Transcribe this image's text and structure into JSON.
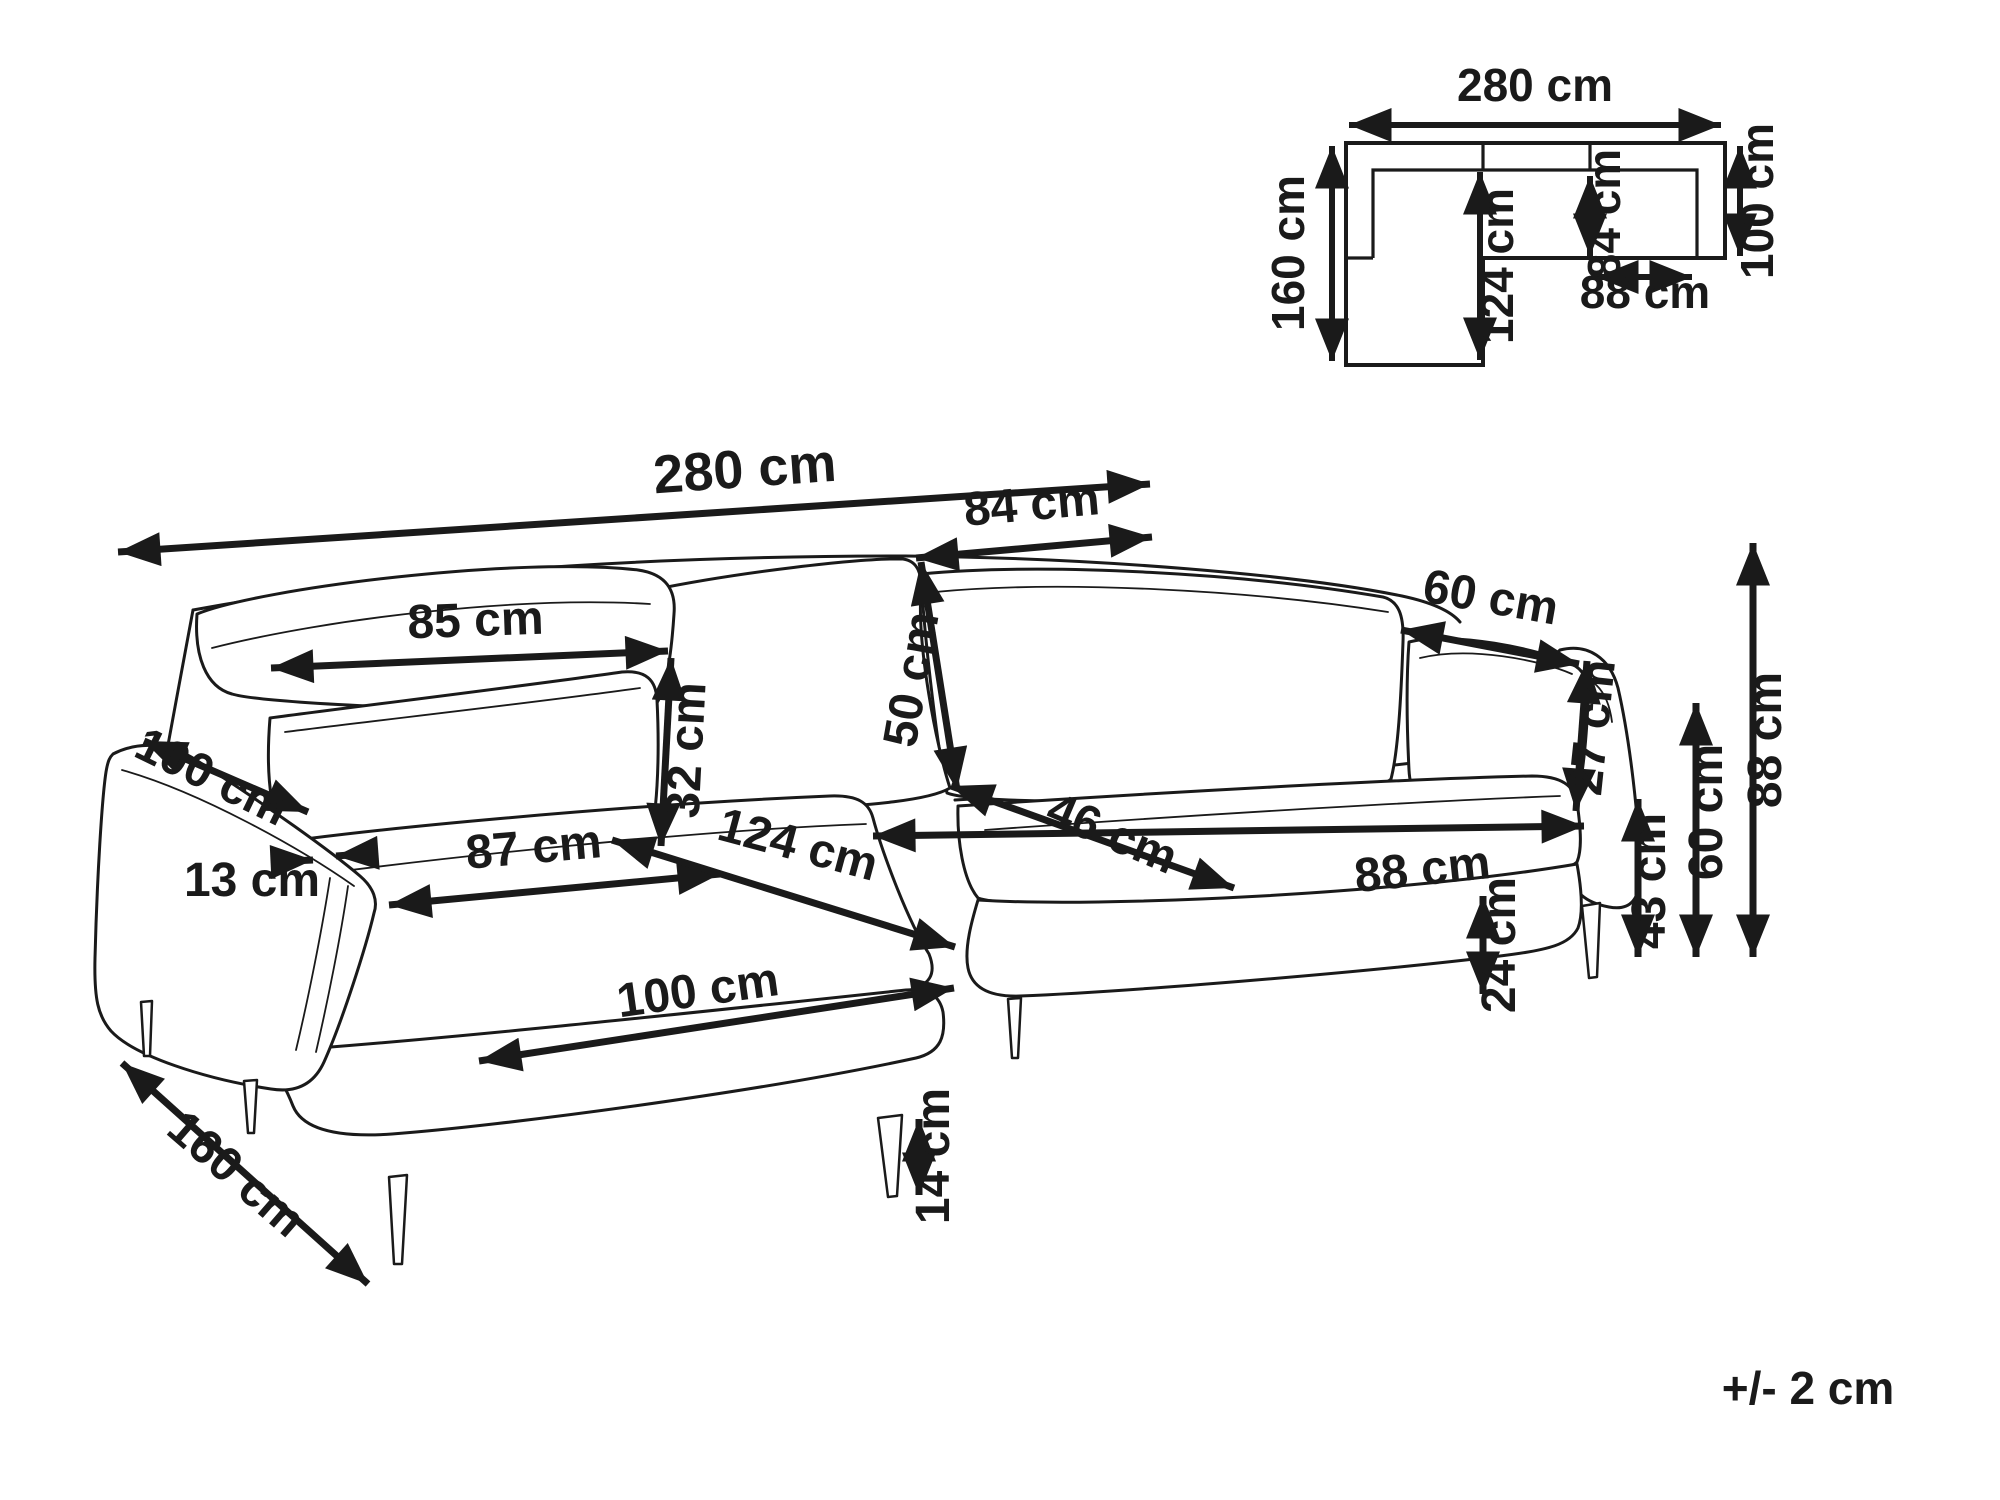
{
  "tolerance_note": "+/- 2 cm",
  "unit": "cm",
  "floorplan": {
    "overall_width_cm": 280,
    "overall_depth_cm": 160,
    "body_depth_cm": 100,
    "chaise_inner_length_cm": 124,
    "seat_depth_cm": 84,
    "seat_width_cm": 88,
    "dimensions": [
      {
        "id": "plan-width-total",
        "label": "280 cm",
        "line": [
          1349,
          125,
          1721,
          125
        ],
        "tx": 1535,
        "ty": 101,
        "rot": 0,
        "fs": 46
      },
      {
        "id": "plan-depth-total",
        "label": "160 cm",
        "line": [
          1332,
          146,
          1332,
          361
        ],
        "tx": 1304,
        "ty": 253,
        "rot": -90,
        "fs": 46
      },
      {
        "id": "plan-body-depth",
        "label": "100 cm",
        "line": [
          1740,
          146,
          1740,
          256
        ],
        "tx": 1773,
        "ty": 201,
        "rot": -90,
        "fs": 46
      },
      {
        "id": "plan-chaise-length",
        "label": "124 cm",
        "line": [
          1480,
          172,
          1480,
          360
        ],
        "tx": 1513,
        "ty": 266,
        "rot": -90,
        "fs": 46
      },
      {
        "id": "plan-seat-depth",
        "label": "84 cm",
        "line": [
          1590,
          176,
          1590,
          256
        ],
        "tx": 1620,
        "ty": 214,
        "rot": -90,
        "fs": 46
      },
      {
        "id": "plan-seat-width",
        "label": "88 cm",
        "line": [
          1596,
          277,
          1692,
          277
        ],
        "tx": 1645,
        "ty": 308,
        "rot": 0,
        "fs": 46
      }
    ]
  },
  "drawing": {
    "dimensions": [
      {
        "id": "width-total",
        "label": "280 cm",
        "line": [
          118,
          552,
          1150,
          484
        ],
        "tx": 746,
        "ty": 487,
        "rot": -4,
        "fs": 54
      },
      {
        "id": "back-cushion-mid-width",
        "label": "84 cm",
        "line": [
          916,
          558,
          1152,
          537
        ],
        "tx": 1033,
        "ty": 520,
        "rot": -5,
        "fs": 48
      },
      {
        "id": "back-cushion-left-width",
        "label": "85 cm",
        "line": [
          271,
          668,
          668,
          651
        ],
        "tx": 476,
        "ty": 636,
        "rot": -2,
        "fs": 48
      },
      {
        "id": "back-cushion-right-width",
        "label": "60 cm",
        "line": [
          1401,
          630,
          1579,
          664
        ],
        "tx": 1488,
        "ty": 613,
        "rot": 10,
        "fs": 48
      },
      {
        "id": "front-pillow-height",
        "label": "32 cm",
        "line": [
          671,
          658,
          661,
          846
        ],
        "tx": 702,
        "ty": 751,
        "rot": -87,
        "fs": 48
      },
      {
        "id": "back-cushion-height",
        "label": "50 cm",
        "line": [
          921,
          562,
          957,
          790
        ],
        "tx": 927,
        "ty": 682,
        "rot": -80,
        "fs": 48
      },
      {
        "id": "armrest-cushion-height",
        "label": "27 cm",
        "line": [
          1587,
          661,
          1576,
          811
        ],
        "tx": 1608,
        "ty": 729,
        "rot": -84,
        "fs": 48
      },
      {
        "id": "armrest-length",
        "label": "100 cm",
        "line": [
          144,
          741,
          308,
          812
        ],
        "tx": 205,
        "ty": 791,
        "rot": 26,
        "fs": 48
      },
      {
        "id": "armrest-width",
        "label": "13 cm",
        "tx": 252,
        "ty": 896,
        "rot": 0,
        "fs": 48
      },
      {
        "id": "armrest-width-arrow-left",
        "label": "",
        "line": [
          271,
          862,
          313,
          860
        ],
        "heads": "end"
      },
      {
        "id": "armrest-width-arrow-right",
        "label": "",
        "line": [
          376,
          853,
          336,
          856
        ],
        "heads": "end"
      },
      {
        "id": "chaise-seat-width",
        "label": "87 cm",
        "line": [
          389,
          905,
          720,
          874
        ],
        "tx": 535,
        "ty": 863,
        "rot": -5,
        "fs": 48
      },
      {
        "id": "chaise-seat-length",
        "label": "124 cm",
        "line": [
          612,
          840,
          955,
          947
        ],
        "tx": 794,
        "ty": 860,
        "rot": 15,
        "fs": 48
      },
      {
        "id": "seat-depth",
        "label": "46 cm",
        "line": [
          951,
          786,
          1234,
          888
        ],
        "tx": 1106,
        "ty": 848,
        "rot": 23,
        "fs": 48
      },
      {
        "id": "seat-cushion-width",
        "label": "88 cm",
        "line": [
          873,
          836,
          1584,
          826
        ],
        "tx": 1424,
        "ty": 885,
        "rot": -6,
        "fs": 48
      },
      {
        "id": "chaise-cushion-length",
        "label": "100 cm",
        "line": [
          479,
          1061,
          954,
          988
        ],
        "tx": 700,
        "ty": 1006,
        "rot": -8,
        "fs": 48
      },
      {
        "id": "chaise-total-length",
        "label": "160 cm",
        "line": [
          122,
          1063,
          368,
          1284
        ],
        "tx": 226,
        "ty": 1186,
        "rot": 41,
        "fs": 48
      },
      {
        "id": "leg-height",
        "label": "14 cm",
        "line": [
          919,
          1119,
          919,
          1195
        ],
        "tx": 949,
        "ty": 1156,
        "rot": -90,
        "fs": 48
      },
      {
        "id": "base-height",
        "label": "24 cm",
        "line": [
          1483,
          896,
          1483,
          994
        ],
        "tx": 1515,
        "ty": 945,
        "rot": -90,
        "fs": 48
      },
      {
        "id": "seat-height",
        "label": "43 cm",
        "line": [
          1638,
          799,
          1638,
          957
        ],
        "tx": 1665,
        "ty": 881,
        "rot": -90,
        "fs": 48
      },
      {
        "id": "armrest-height",
        "label": "60 cm",
        "line": [
          1696,
          703,
          1696,
          957
        ],
        "tx": 1722,
        "ty": 812,
        "rot": -90,
        "fs": 48
      },
      {
        "id": "total-height",
        "label": "88 cm",
        "line": [
          1753,
          543,
          1753,
          957
        ],
        "tx": 1781,
        "ty": 740,
        "rot": -90,
        "fs": 48
      }
    ]
  }
}
